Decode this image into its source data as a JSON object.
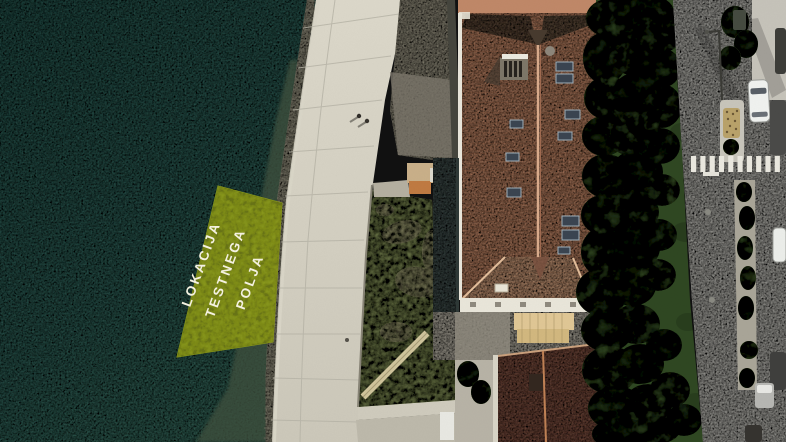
{
  "map": {
    "type": "aerial-orthophoto",
    "annotation": {
      "lines": [
        "LOKACIJA",
        "TESTNEGA",
        "POLJA"
      ],
      "text_color": "#f6f3e2",
      "highlight_fill": "#a9ba22"
    },
    "colors": {
      "sea": "#2e5c55",
      "promenade": "#d6d2c4",
      "grass": "#7f8c55",
      "main_roof": "#c2896a",
      "secondary_roof": "#7d5244",
      "trees": "#2f4722",
      "road": "#b8b7b1",
      "crosswalk": "#eae8df"
    },
    "features": [
      "sea",
      "waterfront-promenade",
      "test-field-highlight",
      "grass-garden",
      "main-building-roof",
      "annex-roof",
      "secondary-building-roof",
      "tree-row",
      "road",
      "crosswalk",
      "median-flowerbed",
      "white-car",
      "parked-vehicles",
      "pedestrians"
    ],
    "pedestrian_count": 2
  }
}
